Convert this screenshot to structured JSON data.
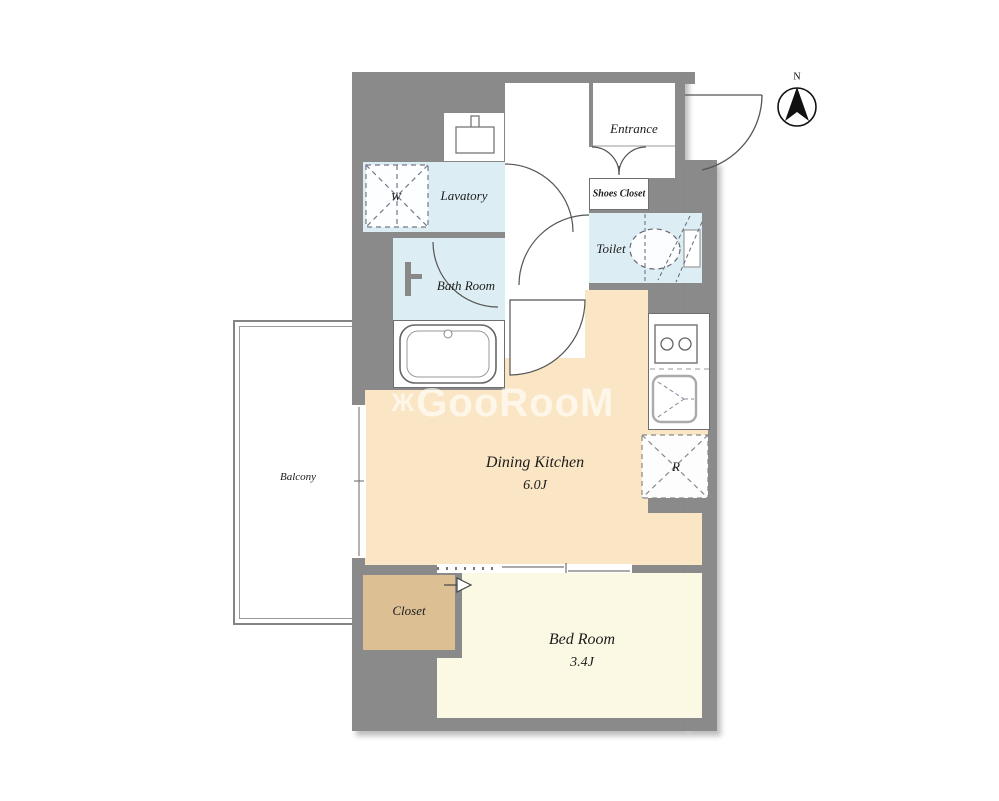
{
  "compass": {
    "north_label": "N"
  },
  "watermark": {
    "mark": "Ж",
    "text": "GooRooM"
  },
  "rooms": {
    "entrance": {
      "label": "Entrance"
    },
    "shoes_closet": {
      "label": "Shoes Closet"
    },
    "lavatory": {
      "label": "Lavatory"
    },
    "washing_machine": {
      "label": "W"
    },
    "toilet": {
      "label": "Toilet"
    },
    "bath_room": {
      "label": "Bath Room"
    },
    "dining_kitchen": {
      "label": "Dining Kitchen",
      "size": "6.0J"
    },
    "refrigerator": {
      "label": "R"
    },
    "bed_room": {
      "label": "Bed Room",
      "size": "3.4J"
    },
    "closet": {
      "label": "Closet"
    },
    "balcony": {
      "label": "Balcony"
    }
  },
  "colors": {
    "wall": "#8a8a8a",
    "dining_kitchen_floor": "#fae6c4",
    "bed_room_floor": "#fbf8e3",
    "closet_floor": "#dcc094",
    "wet_area_floor": "#dceef3",
    "white_floor": "#ffffff",
    "linework": "#555555",
    "watermark": "rgba(255,255,255,0.62)"
  }
}
